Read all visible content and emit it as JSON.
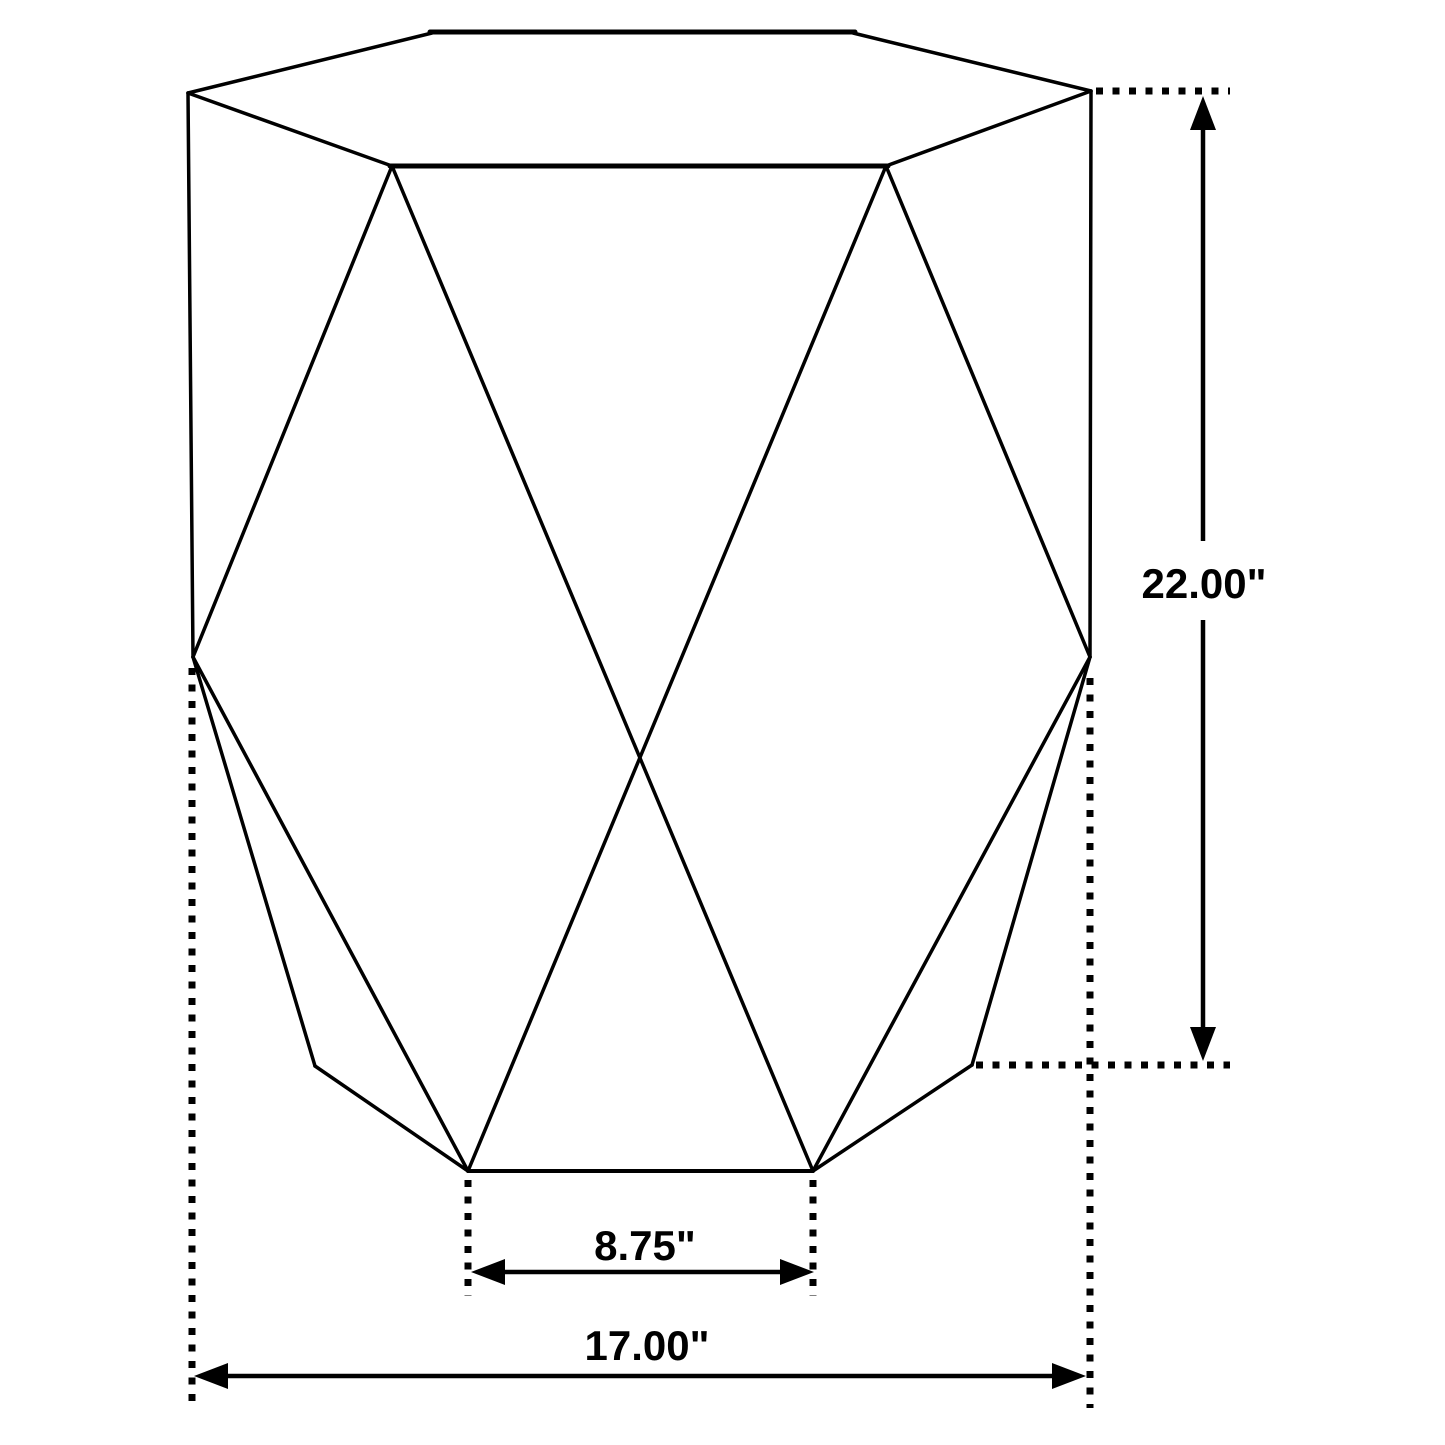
{
  "diagram": {
    "type": "product-dimension-line-drawing",
    "subject": "hexagonal faceted accent table",
    "background_color": "#ffffff",
    "line_color": "#000000",
    "dimensions": {
      "height": {
        "label": "22.00\"",
        "value_inches": 22.0,
        "orientation": "vertical",
        "side": "right"
      },
      "overall_width": {
        "label": "17.00\"",
        "value_inches": 17.0,
        "orientation": "horizontal",
        "side": "bottom"
      },
      "base_front_width": {
        "label": "8.75\"",
        "value_inches": 8.75,
        "orientation": "horizontal",
        "side": "bottom-inner"
      }
    }
  }
}
